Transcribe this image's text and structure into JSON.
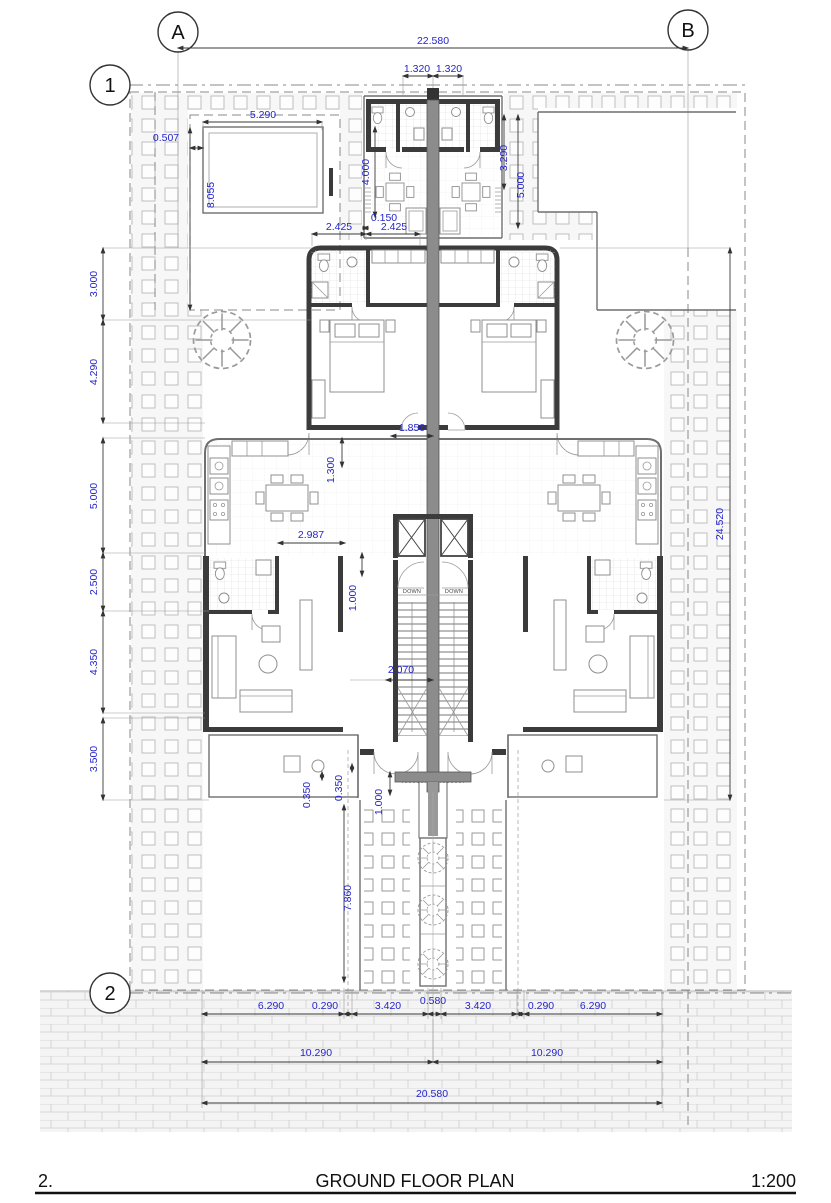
{
  "document": {
    "sheet_number": "2.",
    "sheet_title": "GROUND FLOOR PLAN",
    "sheet_scale": "1:200"
  },
  "grid_markers": {
    "column_a": "A",
    "column_b": "B",
    "row_1": "1",
    "row_2": "2"
  },
  "stair_labels": {
    "left": "DOWN",
    "right": "DOWN"
  },
  "dimensions": {
    "site_width": "22.580",
    "core_half_left": "1.320",
    "core_half_right": "1.320",
    "carport": {
      "width": "5.290",
      "offset": "0.507",
      "depth": "4.000",
      "yard_depth": "8.055"
    },
    "upper_terrace": {
      "inner_depth": "3.290",
      "depth": "5.000",
      "wall_offset": "0.150",
      "bay_left": "2.425",
      "bay_right": "2.425"
    },
    "left_chain": [
      "3.000",
      "4.290",
      "5.000",
      "2.500",
      "4.350",
      "3.500"
    ],
    "interior": {
      "bedroom_opening": "1.850",
      "hall_depth": "1.300",
      "living_width": "2.987",
      "stair_landing": "1.000",
      "stair_clearance": "2.070",
      "patio_step_a": "0.350",
      "patio_step_b": "0.350",
      "entry_depth": "1.000",
      "walkway_length": "7.860"
    },
    "building_depth": "24.520",
    "bottom": {
      "path_split": "0.580",
      "chain": [
        "6.290",
        "0.290",
        "3.420",
        "3.420",
        "0.290",
        "6.290"
      ],
      "unit_left": "10.290",
      "unit_right": "10.290",
      "building_width": "20.580"
    }
  },
  "colors": {
    "dimension_text": "#2424cd",
    "wall_fill": "#3b3b3b",
    "core_fill": "#8c8c8c",
    "thin_line": "#6f6f6f",
    "paver_line": "#b9b9b9",
    "brick_line": "#cfcfcf"
  }
}
